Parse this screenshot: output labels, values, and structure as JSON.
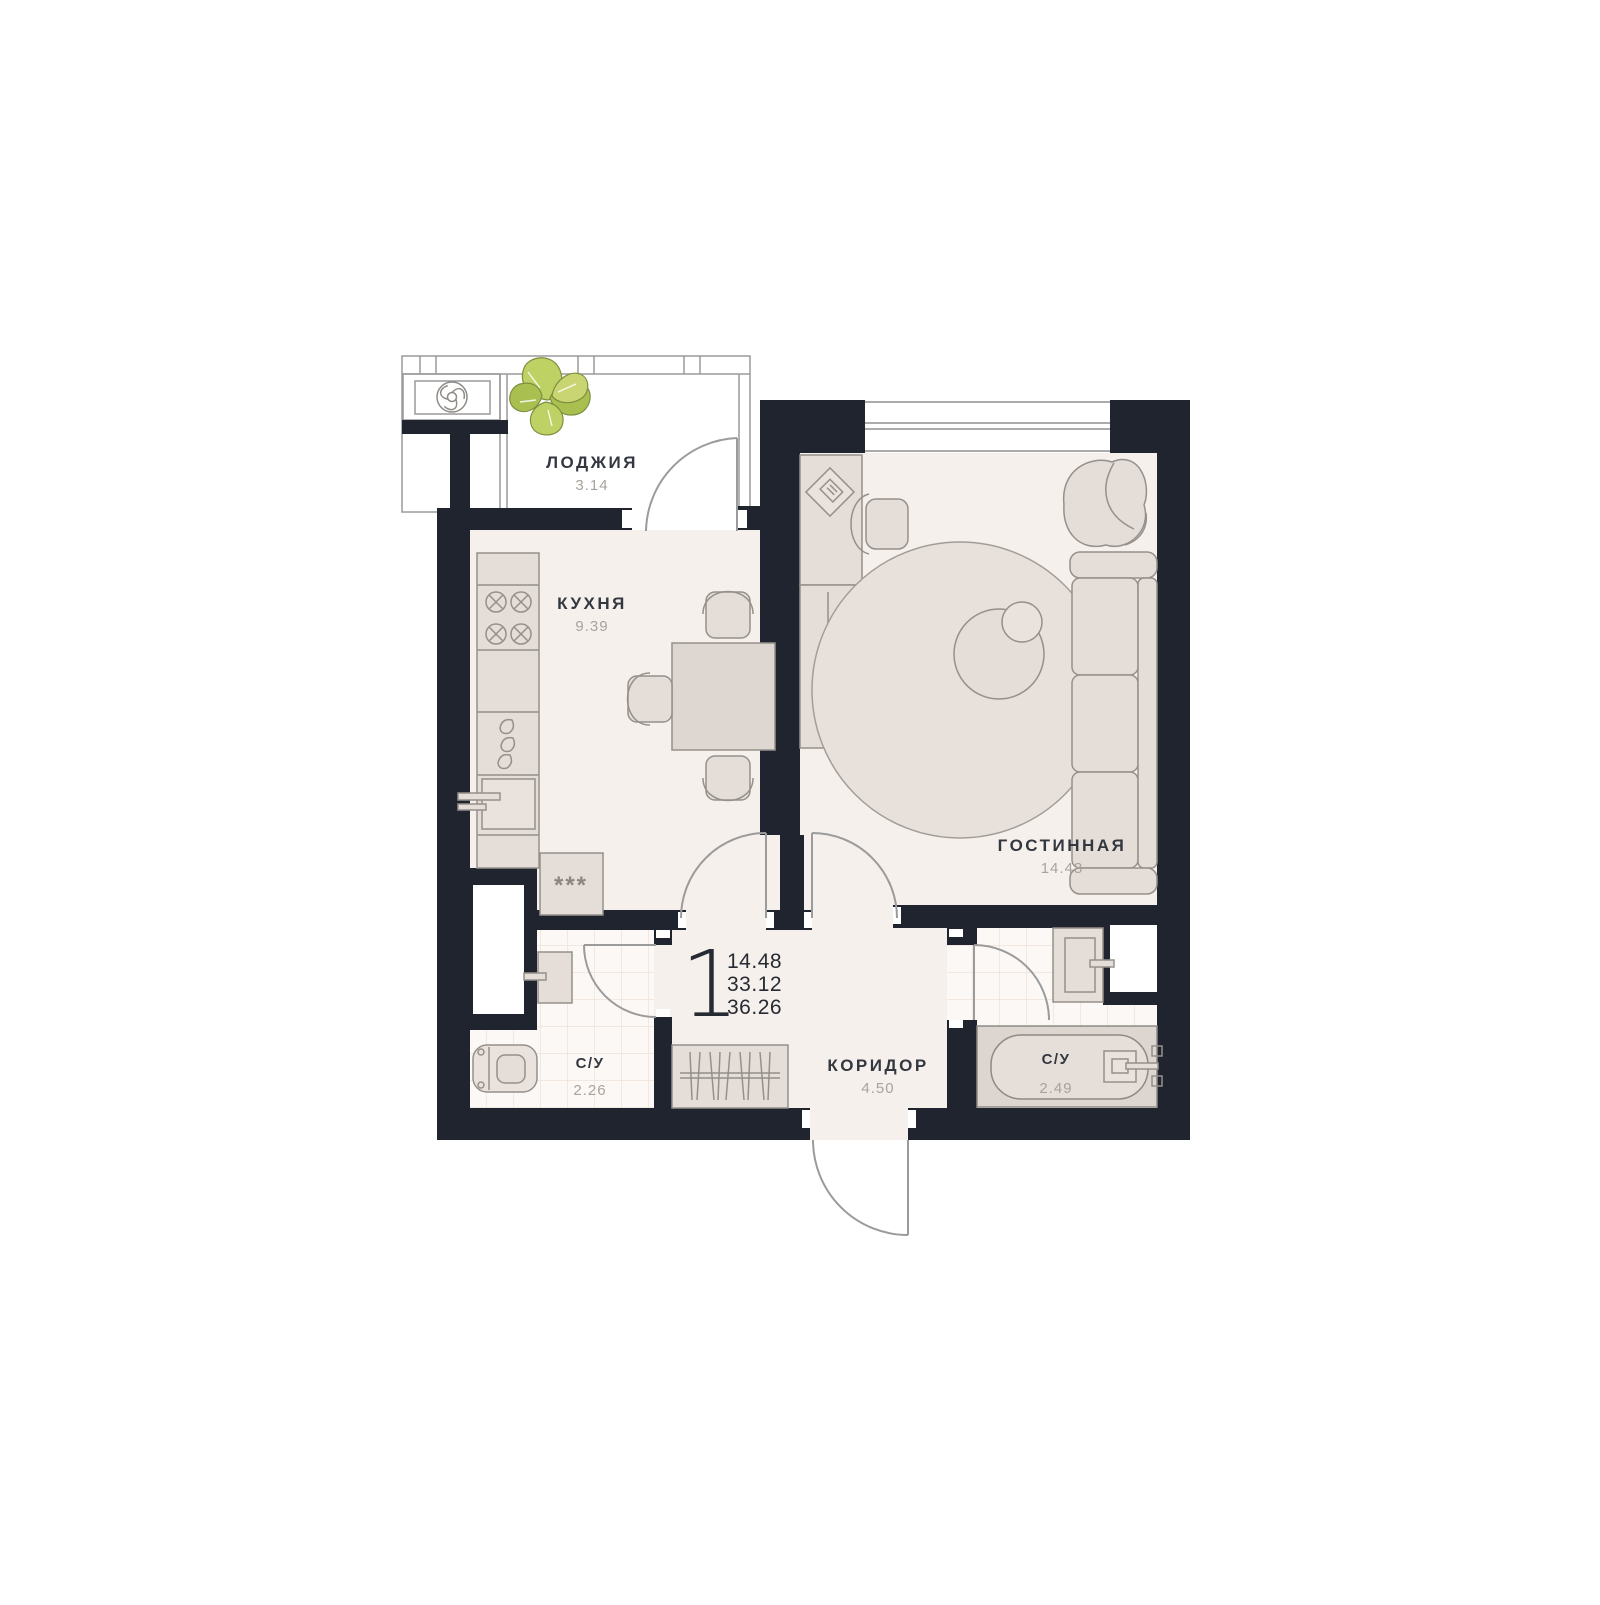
{
  "plan": {
    "title": "apartment-floor-plan",
    "unit": {
      "number": "1",
      "area_living": "14.48",
      "area_no_loggia": "33.12",
      "area_total": "36.26"
    },
    "rooms": [
      {
        "id": "loggia",
        "name": "ЛОДЖИЯ",
        "area": "3.14"
      },
      {
        "id": "kitchen",
        "name": "КУХНЯ",
        "area": "9.39"
      },
      {
        "id": "living",
        "name": "ГОСТИННАЯ",
        "area": "14.48"
      },
      {
        "id": "bath1",
        "name": "С/У",
        "area": "2.26"
      },
      {
        "id": "corridor",
        "name": "КОРИДОР",
        "area": "4.50"
      },
      {
        "id": "bath2",
        "name": "С/У",
        "area": "2.49"
      }
    ],
    "fridge_label": "***",
    "colors": {
      "wall": "#20242f",
      "floor": "#f6f0ec",
      "tile": "#fcf8f5",
      "tile_line": "#f0e2da",
      "furniture": "#e5ddd7",
      "plant_leaf": "#bed164",
      "plant_dark": "#a9bf50",
      "label_dark": "#33373f",
      "label_grey": "#a9a29c"
    }
  }
}
